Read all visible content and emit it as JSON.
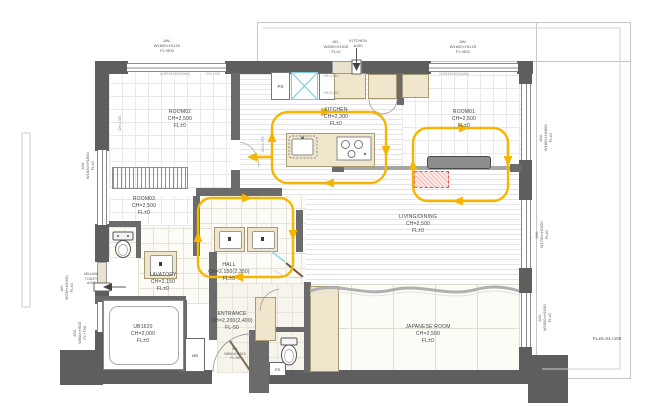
{
  "plan": {
    "rooms": [
      {
        "name": "ROOM02",
        "ch": "CH=2,500",
        "fl": "FL±0"
      },
      {
        "name": "KITCHEN",
        "ch": "CH=2,300",
        "fl": "FL±0"
      },
      {
        "name": "ROOM01",
        "ch": "CH=2,500",
        "fl": "FL±0"
      },
      {
        "name": "ROOM03",
        "ch": "CH=2,500",
        "fl": "FL±0"
      },
      {
        "name": "LIVING/DINING",
        "ch": "CH=2,500",
        "fl": "FL±0"
      },
      {
        "name": "HALL",
        "ch": "CH=2,150(2,350)",
        "fl": "FL±0"
      },
      {
        "name": "LAVATORY",
        "ch": "CH=2,150",
        "fl": "FL±0"
      },
      {
        "name": "ENTRANCE",
        "ch": "CH=2,200(2,400)",
        "fl": "FL-50"
      },
      {
        "name": "UB1620",
        "ch": "CH=2,000",
        "fl": "FL±0"
      },
      {
        "name": "JAPANESE ROOM",
        "ch": "CH=2,500",
        "fl": "FL±0"
      }
    ],
    "openings": {
      "top_left": {
        "a": "AW-",
        "b": "W1800×H1120",
        "c": "FL+800"
      },
      "top_door": {
        "a": "AD-",
        "b": "W830×H1915",
        "c": "FL±0"
      },
      "duct_kitchen": {
        "a": "KITCHEN",
        "b": "ø150"
      },
      "top_right": {
        "a": "AW-",
        "b": "W1800×H1125",
        "c": "FL+800"
      },
      "right1": {
        "a": "AW-",
        "b": "W1800×H1800",
        "c": "FL±0"
      },
      "right2": {
        "a": "AW-",
        "b": "W1700×H1500",
        "c": "FL±0"
      },
      "right3": {
        "a": "AW-",
        "b": "W1800×H1500",
        "c": "FL±0"
      },
      "left1": {
        "a": "AW-",
        "b": "W1820×H1800",
        "c": "FL±0"
      },
      "left_door": {
        "a": "AD-",
        "b": "W730×H1930",
        "c": "FL±0"
      },
      "duct_ub": {
        "a": "UB/LAVA",
        "b": "TOILET",
        "c": "ø100"
      },
      "left2": {
        "a": "AW-",
        "b": "W800×H915",
        "c": "FL+750"
      },
      "entrance_door": {
        "a": "SD-",
        "b": "W800×H1915",
        "c": "FL-55"
      }
    },
    "notes": {
      "mb": "MB",
      "ps_top": "PS",
      "ps_bottom": "PS",
      "level": "FL±0=SL+100",
      "ch_a": "CH=1,910",
      "ch_b": "CH=2,150",
      "ch_c": "CH=1,975",
      "ch_d": "CH=2,380",
      "curtain_left": "CURTAIN BOX(W60)",
      "curtain_right": "CURTAIN BOX(W60)"
    },
    "colors": {
      "wall": "#5e5e5e",
      "flow": "#f5b501",
      "vent": "#7ccde2",
      "alert": "#e0584d",
      "fixture": "#efe6cb"
    }
  }
}
